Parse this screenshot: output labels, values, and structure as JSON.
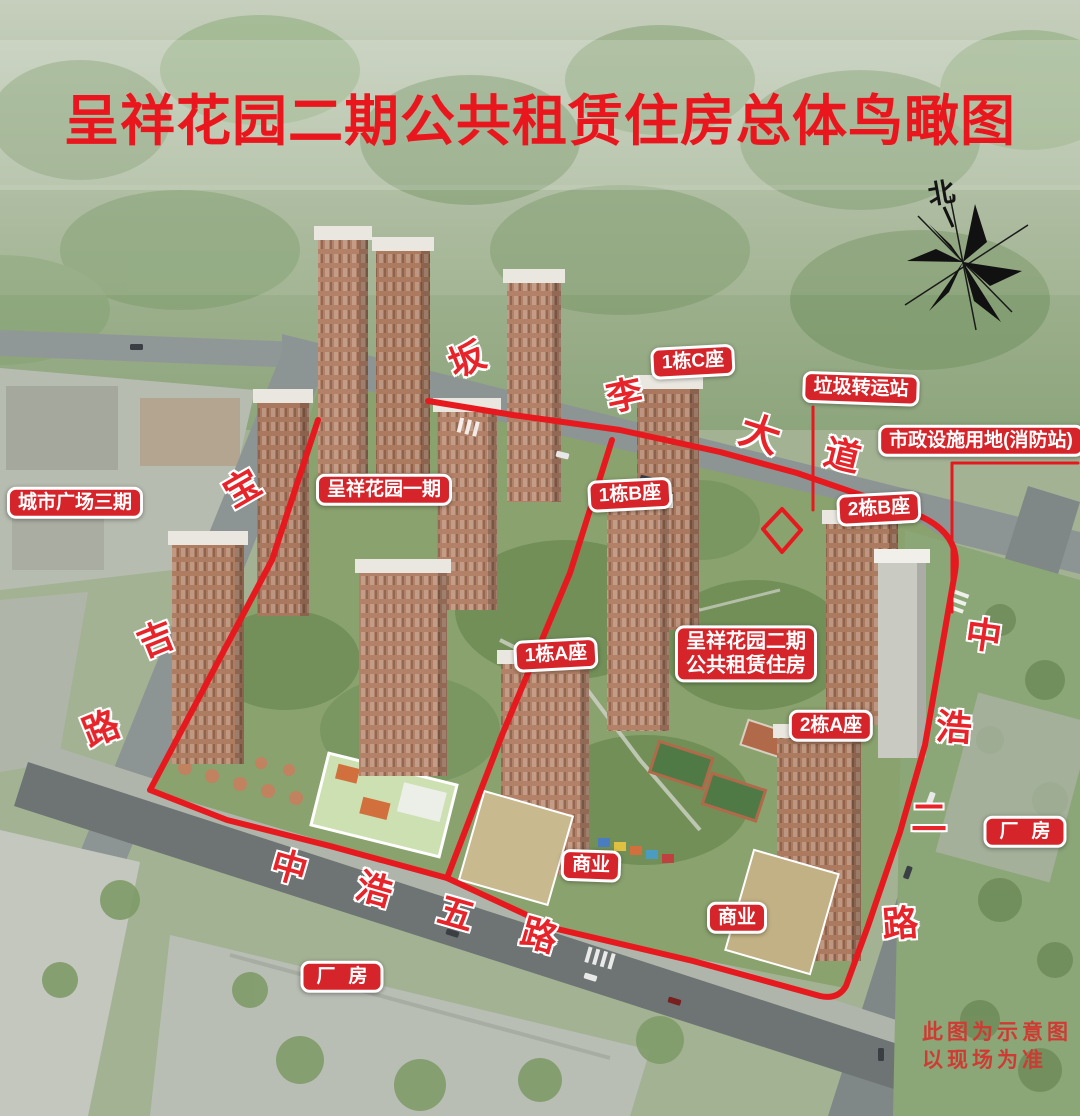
{
  "title": "呈祥花园二期公共租赁住房总体鸟瞰图",
  "compass": {
    "north_label": "北"
  },
  "badges": [
    {
      "id": "building-1c",
      "text": "1栋C座"
    },
    {
      "id": "garbage-transfer-station",
      "text": "垃圾转运站"
    },
    {
      "id": "municipal-facility",
      "text": "市政设施用地(消防站)"
    },
    {
      "id": "city-plaza-phase3",
      "text": "城市广场三期"
    },
    {
      "id": "garden-phase1",
      "text": "呈祥花园一期"
    },
    {
      "id": "building-1b",
      "text": "1栋B座"
    },
    {
      "id": "building-2b",
      "text": "2栋B座"
    },
    {
      "id": "building-1a",
      "text": "1栋A座"
    },
    {
      "id": "garden-phase2",
      "lines": [
        "呈祥花园二期",
        "公共租赁住房"
      ]
    },
    {
      "id": "building-2a",
      "text": "2栋A座"
    },
    {
      "id": "commercial-west",
      "text": "商业"
    },
    {
      "id": "commercial-east",
      "text": "商业"
    },
    {
      "id": "factory-south",
      "text": "厂房"
    },
    {
      "id": "factory-east",
      "text": "厂房"
    }
  ],
  "roads": {
    "banli_dadao": [
      "坂",
      "李",
      "大",
      "道"
    ],
    "baoji_lu": [
      "宝",
      "吉",
      "路"
    ],
    "zhonghao_wulu": [
      "中",
      "浩",
      "五",
      "路"
    ],
    "zhonghao_erlu": [
      "中",
      "浩",
      "二",
      "路"
    ]
  },
  "disclaimer": [
    "此图为示意图",
    "以现场为准"
  ],
  "colors": {
    "label_red": "#d5252b",
    "title_red": "#ea161d",
    "road_char_red": "#e8242b",
    "boundary_red": "#e6191f",
    "disclaimer_red": "#cf3a33"
  }
}
